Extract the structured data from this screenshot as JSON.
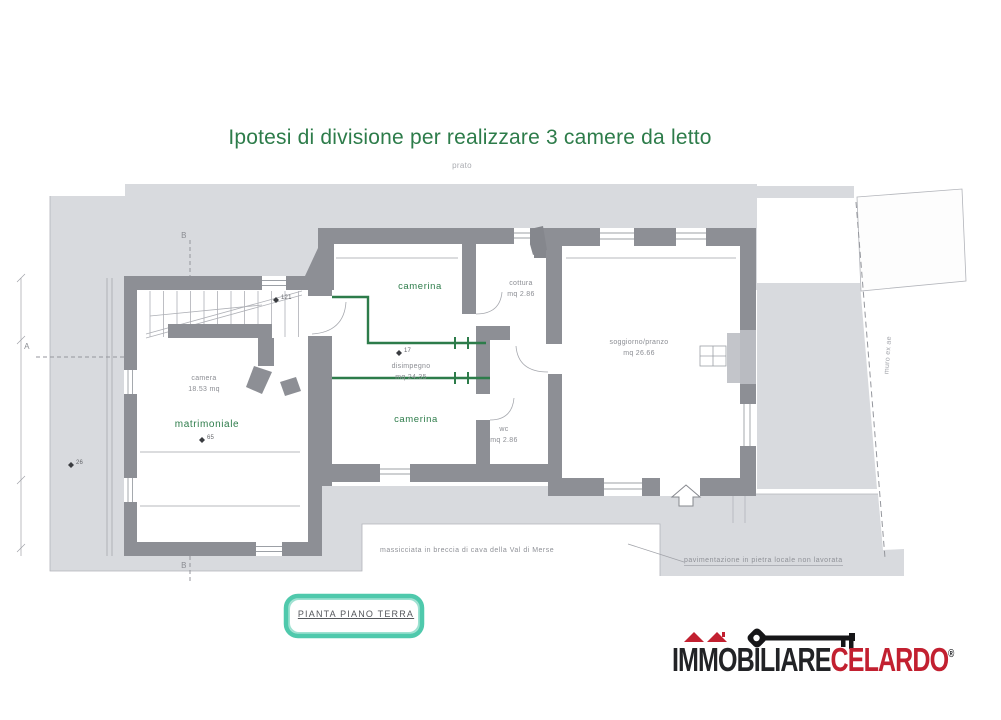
{
  "title": {
    "text": "Ipotesi di divisione per realizzare 3 camere da letto"
  },
  "site": {
    "prato": "prato",
    "muro_ex": "muro ex ae",
    "massicciata": "massicciata in breccia di cava della Val di Merse",
    "pavimentazione": "pavimentazione in pietra locale non lavorata"
  },
  "plan": {
    "label": "PIANTA PIANO TERRA",
    "rooms": [
      {
        "name": "camerina",
        "area": ""
      },
      {
        "name": "cottura",
        "area": "mq 2.86"
      },
      {
        "name": "soggiorno/pranzo",
        "area": "mq 26.66"
      },
      {
        "name": "disimpegno",
        "area": "mq 24.35"
      },
      {
        "name": "camerina",
        "area": ""
      },
      {
        "name": "wc",
        "area": "mq 2.86"
      },
      {
        "name": "camera",
        "area": "18.53 mq"
      },
      {
        "name": "matrimoniale",
        "area": ""
      }
    ],
    "sections": {
      "a": "A",
      "b": "B"
    },
    "levels": [
      {
        "value": "121"
      },
      {
        "value": "17"
      },
      {
        "value": "65"
      },
      {
        "value": "26"
      }
    ]
  },
  "logo": {
    "name_black": "IMMOBILIARE",
    "name_red": "CELARDO",
    "registered": "®"
  },
  "colors": {
    "title_green": "#2d7c4a",
    "label_green": "#2d7c4a",
    "partition_green": "#2d7c4a",
    "highlight_teal": "#4fc9ac",
    "logo_red": "#c22030",
    "logo_black": "#222326",
    "wall_gray": "#8d8f95",
    "ground_gray": "#d8dade"
  }
}
